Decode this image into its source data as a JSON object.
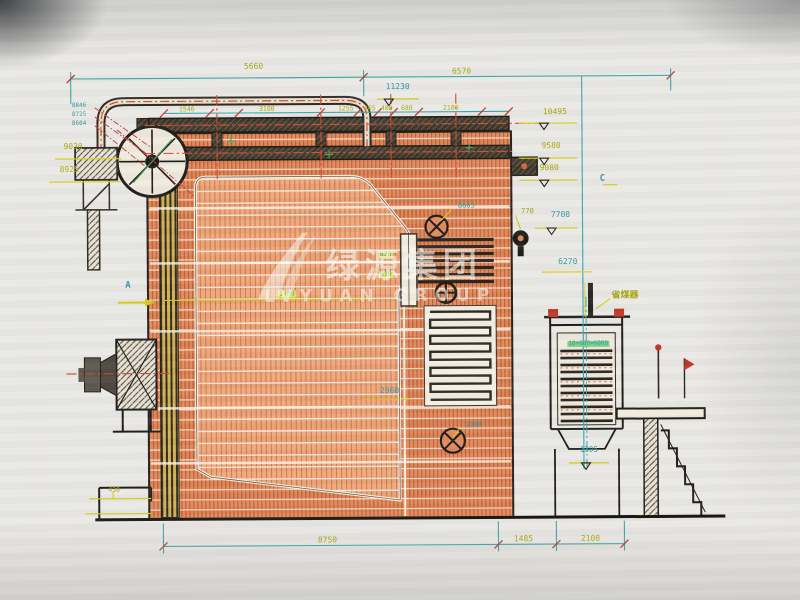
{
  "watermark": {
    "cn": "绿源集团",
    "en": "LVYUAN GROUP"
  },
  "sections": {
    "a": "A",
    "c": "C"
  },
  "equipment": {
    "economizer_cn": "省煤器"
  },
  "dimensions": {
    "top_left": "5660",
    "top_right": "6570",
    "header": [
      "1546",
      "3100",
      "1255",
      "465",
      "480",
      "680",
      "2180"
    ],
    "bottom": [
      "8750",
      "1485",
      "2100"
    ],
    "furnace_width": "2960",
    "rear_width": "2100",
    "burner_opening": "430",
    "level_1480": "1480",
    "econ_tubes": "10×600=6000",
    "exit_upper": "620",
    "exit_lower": "610",
    "valve_height": "770"
  },
  "elevations": {
    "e11230": "11230",
    "e10495": "10495",
    "e9580": "9580",
    "e9080": "9080",
    "e9030": "9030",
    "e8925": "8925",
    "stack": [
      "8846",
      "8725",
      "8604"
    ],
    "e8603": "8603",
    "e7708": "7708",
    "e6270": "6270",
    "e1305": "1305"
  },
  "palette": {
    "teal_lines": "#3aa3ad",
    "yellow_lines": "#d6ce18",
    "orange_hatch": "#e0885a",
    "red_marks": "#c0392b",
    "green_marks": "#3aa355",
    "ink": "#1d1a16"
  }
}
